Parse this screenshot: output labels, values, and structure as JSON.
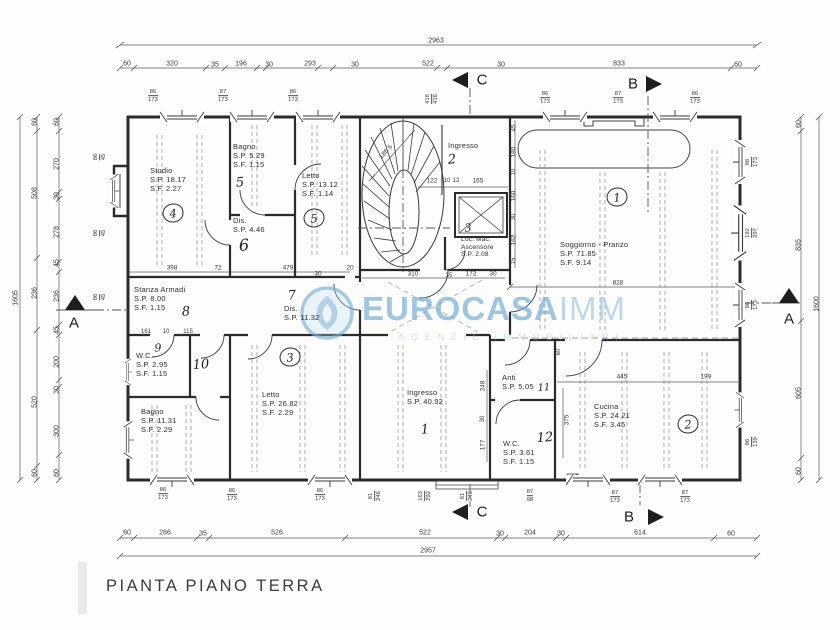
{
  "title": "PIANTA PIANO TERRA",
  "watermark": {
    "brand": "EUROCASA",
    "brand_suffix": "IMM",
    "subtitle": "AGENZIE IMMOBILIARI",
    "color": "#7fb3d8"
  },
  "sections": {
    "a": "A",
    "b": "B",
    "c": "C"
  },
  "rooms": {
    "studio": {
      "name": "Studio",
      "sp": "S.P. 18.17",
      "sf": "S.F. 2.27",
      "num": "4"
    },
    "bagno_top": {
      "name": "Bagno",
      "sp": "S.P. 5.29",
      "sf": "S.F. 1.15",
      "num": "5"
    },
    "letto_top": {
      "name": "Letto",
      "sp": "S.P. 13.12",
      "sf": "S.F. 1.14",
      "num": "5"
    },
    "dis_top": {
      "name": "Dis.",
      "sp": "S.P. 4.46",
      "num": "6"
    },
    "ingresso_top": {
      "name": "Ingresso",
      "num": "2"
    },
    "ascensore": {
      "name": "Loc. Mac.",
      "name2": "Ascensore",
      "sp": "S.P. 2.08",
      "num": "3"
    },
    "soggiorno": {
      "name": "Soggiorno - Pranzo",
      "sp": "S.P. 71.85",
      "sf": "S.F. 9.14",
      "num": "1"
    },
    "stanza_armadi": {
      "name": "Stanza Armadi",
      "sp": "S.P. 8.00",
      "sf": "S.F. 1.15",
      "num": "8"
    },
    "dis_mid": {
      "name": "Dis.",
      "sp": "S.P. 11.32",
      "num": "7"
    },
    "wc_left": {
      "name": "W.C.",
      "sp": "S.P. 2.95",
      "sf": "S.F. 1.15",
      "num": "9",
      "num2": "10"
    },
    "bagno_bottom": {
      "name": "Bagno",
      "sp": "S.P. 11.31",
      "sf": "S.F. 2.29"
    },
    "letto_bottom": {
      "name": "Letto",
      "sp": "S.P. 26.82",
      "sf": "S.F. 2.29",
      "num": "3"
    },
    "ingresso_main": {
      "name": "Ingresso",
      "sp": "S.P. 40.92",
      "num": "1"
    },
    "anti": {
      "name": "Anti",
      "sp": "S.P. 5.05",
      "num": "11"
    },
    "wc_right": {
      "name": "W.C.",
      "sp": "S.P. 3.61",
      "sf": "S.F. 1.15",
      "num": "12"
    },
    "cucina": {
      "name": "Cucina",
      "sp": "S.P. 24.21",
      "sf": "S.F. 3.45",
      "num": "2"
    }
  },
  "dim_labels": [
    {
      "t": "2963",
      "x": 436,
      "y": 41
    },
    {
      "t": "60",
      "x": 127,
      "y": 64
    },
    {
      "t": "320",
      "x": 172,
      "y": 64
    },
    {
      "t": "35",
      "x": 215,
      "y": 65
    },
    {
      "t": "196",
      "x": 241,
      "y": 64
    },
    {
      "t": "30",
      "x": 269,
      "y": 65
    },
    {
      "t": "293",
      "x": 310,
      "y": 64
    },
    {
      "t": "30",
      "x": 355,
      "y": 65
    },
    {
      "t": "522",
      "x": 428,
      "y": 64
    },
    {
      "t": "30",
      "x": 501,
      "y": 65
    },
    {
      "t": "833",
      "x": 619,
      "y": 64
    },
    {
      "t": "60",
      "x": 738,
      "y": 65
    },
    {
      "t": "60",
      "x": 127,
      "y": 533
    },
    {
      "t": "286",
      "x": 165,
      "y": 533
    },
    {
      "t": "35",
      "x": 203,
      "y": 534
    },
    {
      "t": "526",
      "x": 277,
      "y": 533
    },
    {
      "t": "522",
      "x": 425,
      "y": 533
    },
    {
      "t": "30",
      "x": 500,
      "y": 534
    },
    {
      "t": "204",
      "x": 530,
      "y": 533
    },
    {
      "t": "30",
      "x": 561,
      "y": 534
    },
    {
      "t": "614",
      "x": 640,
      "y": 533
    },
    {
      "t": "60",
      "x": 731,
      "y": 534
    },
    {
      "t": "2957",
      "x": 428,
      "y": 551
    },
    {
      "t": "1605",
      "x": 16,
      "y": 298,
      "r": -90
    },
    {
      "t": "60",
      "x": 35,
      "y": 122,
      "r": -90
    },
    {
      "t": "508",
      "x": 35,
      "y": 193,
      "r": -90
    },
    {
      "t": "236",
      "x": 35,
      "y": 293,
      "r": -90
    },
    {
      "t": "520",
      "x": 35,
      "y": 402,
      "r": -90
    },
    {
      "t": "60",
      "x": 35,
      "y": 473,
      "r": -90
    },
    {
      "t": "60",
      "x": 57,
      "y": 122,
      "r": -90
    },
    {
      "t": "270",
      "x": 57,
      "y": 164,
      "r": -90
    },
    {
      "t": "30",
      "x": 57,
      "y": 196,
      "r": -90
    },
    {
      "t": "278",
      "x": 57,
      "y": 232,
      "r": -90
    },
    {
      "t": "45",
      "x": 57,
      "y": 263,
      "r": -90
    },
    {
      "t": "236",
      "x": 57,
      "y": 296,
      "r": -90
    },
    {
      "t": "45",
      "x": 57,
      "y": 330,
      "r": -90
    },
    {
      "t": "200",
      "x": 57,
      "y": 362,
      "r": -90
    },
    {
      "t": "30",
      "x": 57,
      "y": 390,
      "r": -90
    },
    {
      "t": "300",
      "x": 57,
      "y": 431,
      "r": -90
    },
    {
      "t": "60",
      "x": 57,
      "y": 473,
      "r": -90
    },
    {
      "t": "60",
      "x": 799,
      "y": 124,
      "r": -90
    },
    {
      "t": "835",
      "x": 799,
      "y": 245,
      "r": -90
    },
    {
      "t": "605",
      "x": 799,
      "y": 393,
      "r": -90
    },
    {
      "t": "60",
      "x": 799,
      "y": 471,
      "r": -90
    },
    {
      "t": "1600",
      "x": 817,
      "y": 304,
      "r": -90
    },
    {
      "t": "398",
      "x": 172,
      "y": 268,
      "s": 6.5
    },
    {
      "t": "72",
      "x": 218,
      "y": 268,
      "s": 6.5
    },
    {
      "t": "479",
      "x": 288,
      "y": 268,
      "s": 6.5
    },
    {
      "t": "20",
      "x": 350,
      "y": 268,
      "s": 6.5
    },
    {
      "t": "30",
      "x": 318,
      "y": 274,
      "s": 6.5
    },
    {
      "t": "310",
      "x": 413,
      "y": 274,
      "s": 6.5
    },
    {
      "t": "35",
      "x": 449,
      "y": 276,
      "s": 6
    },
    {
      "t": "172",
      "x": 471,
      "y": 274,
      "s": 6.5
    },
    {
      "t": "30",
      "x": 493,
      "y": 274,
      "s": 6.5
    },
    {
      "t": "161",
      "x": 146,
      "y": 332,
      "s": 6
    },
    {
      "t": "10",
      "x": 166,
      "y": 332,
      "s": 6
    },
    {
      "t": "115",
      "x": 188,
      "y": 332,
      "s": 6
    },
    {
      "t": "122",
      "x": 432,
      "y": 181,
      "s": 6.5
    },
    {
      "t": "10",
      "x": 447,
      "y": 181,
      "s": 6
    },
    {
      "t": "12",
      "x": 456,
      "y": 181,
      "s": 6
    },
    {
      "t": "165",
      "x": 478,
      "y": 181,
      "s": 6.5
    },
    {
      "t": "186.5",
      "x": 386,
      "y": 152,
      "r": -48,
      "s": 6.5
    },
    {
      "t": "45",
      "x": 514,
      "y": 128,
      "r": -90,
      "s": 6.5
    },
    {
      "t": "180",
      "x": 514,
      "y": 152,
      "r": -90,
      "s": 6.5
    },
    {
      "t": "10",
      "x": 514,
      "y": 172,
      "r": -90,
      "s": 6
    },
    {
      "t": "160",
      "x": 514,
      "y": 196,
      "r": -90,
      "s": 6.5
    },
    {
      "t": "30",
      "x": 514,
      "y": 217,
      "r": -90,
      "s": 6
    },
    {
      "t": "162",
      "x": 514,
      "y": 240,
      "r": -90,
      "s": 6.5
    },
    {
      "t": "15",
      "x": 514,
      "y": 261,
      "r": -90,
      "s": 6
    },
    {
      "t": "248",
      "x": 483,
      "y": 386,
      "r": -90,
      "s": 6.5
    },
    {
      "t": "30",
      "x": 483,
      "y": 419,
      "r": -90,
      "s": 6
    },
    {
      "t": "177",
      "x": 483,
      "y": 445,
      "r": -90,
      "s": 6.5
    },
    {
      "t": "828",
      "x": 618,
      "y": 283,
      "s": 6.5
    },
    {
      "t": "445",
      "x": 622,
      "y": 377,
      "s": 6.5
    },
    {
      "t": "199",
      "x": 706,
      "y": 377,
      "s": 6.5
    },
    {
      "t": "375",
      "x": 567,
      "y": 420,
      "r": -90,
      "s": 6.5
    },
    {
      "t": "60",
      "x": 559,
      "y": 352,
      "r": -90,
      "s": 6
    }
  ],
  "win_labels": [
    {
      "t": "86/173",
      "x": 153,
      "y": 96
    },
    {
      "t": "87/173",
      "x": 223,
      "y": 96
    },
    {
      "t": "86/173",
      "x": 293,
      "y": 96
    },
    {
      "t": "418/416",
      "x": 432,
      "y": 99,
      "r": -90
    },
    {
      "t": "86/173",
      "x": 545,
      "y": 98
    },
    {
      "t": "87/173",
      "x": 618,
      "y": 98
    },
    {
      "t": "86/173",
      "x": 695,
      "y": 98
    },
    {
      "t": "86/173",
      "x": 163,
      "y": 494
    },
    {
      "t": "86/173",
      "x": 232,
      "y": 495
    },
    {
      "t": "86/173",
      "x": 320,
      "y": 495
    },
    {
      "t": "81/246",
      "x": 375,
      "y": 496,
      "r": -90
    },
    {
      "t": "163/292",
      "x": 425,
      "y": 496,
      "r": -90
    },
    {
      "t": "81/246",
      "x": 467,
      "y": 496,
      "r": -90
    },
    {
      "t": "87/98",
      "x": 530,
      "y": 496
    },
    {
      "t": "87/173",
      "x": 615,
      "y": 497
    },
    {
      "t": "87/173",
      "x": 685,
      "y": 497
    },
    {
      "t": "86/45",
      "x": 100,
      "y": 157,
      "r": -90
    },
    {
      "t": "86/45",
      "x": 100,
      "y": 233,
      "r": -90
    },
    {
      "t": "86/45",
      "x": 100,
      "y": 297,
      "r": -90
    },
    {
      "t": "86/173",
      "x": 752,
      "y": 162,
      "r": -90
    },
    {
      "t": "192/297",
      "x": 752,
      "y": 233,
      "r": -90
    },
    {
      "t": "86/173",
      "x": 752,
      "y": 305,
      "r": -90
    },
    {
      "t": "86/139",
      "x": 752,
      "y": 442,
      "r": -90
    }
  ]
}
